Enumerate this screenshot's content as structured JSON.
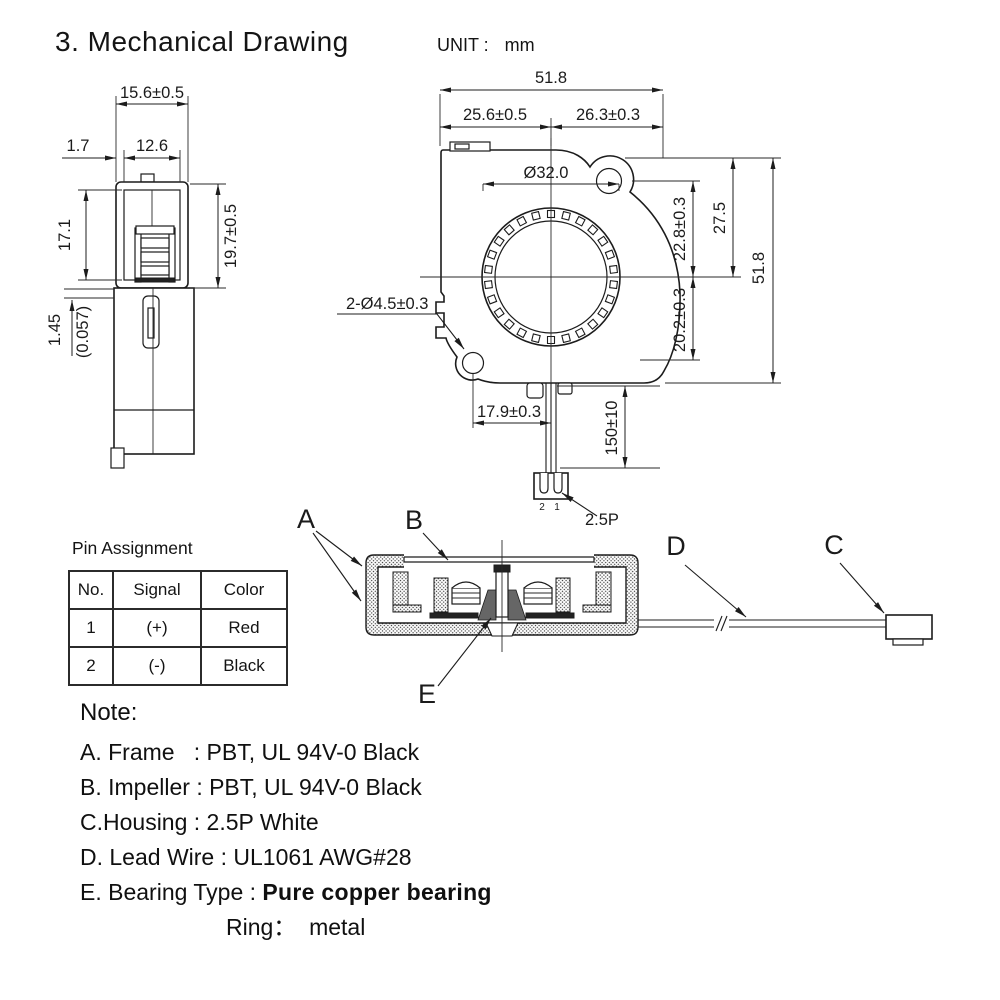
{
  "title": "3. Mechanical Drawing",
  "unit": {
    "label": "UNIT :",
    "value": "mm"
  },
  "side_view": {
    "width": "15.6±0.5",
    "offset": "1.7",
    "inner_width": "12.6",
    "motor_height": "17.1",
    "depth": "19.7±0.5",
    "step": "1.45",
    "step_inch": "(0.057)"
  },
  "front_view": {
    "total_width": "51.8",
    "left_half": "25.6±0.5",
    "right_half": "26.3±0.3",
    "inlet_dia": "Ø32.0",
    "mount_holes": "2-Ø4.5±0.3",
    "hole_to_center": "22.8±0.3",
    "top_to_center": "27.5",
    "total_height": "51.8",
    "center_to_hole": "20.2±0.3",
    "hole_to_wire": "17.9±0.3",
    "lead_length": "150±10",
    "pin_2": "2",
    "pin_1": "1",
    "connector_type": "2.5P"
  },
  "section": {
    "label_a": "A",
    "label_b": "B",
    "label_c": "C",
    "label_d": "D",
    "label_e": "E"
  },
  "pin_table": {
    "title": "Pin Assignment",
    "headers": [
      "No.",
      "Signal",
      "Color"
    ],
    "rows": [
      [
        "1",
        "(+)",
        "Red"
      ],
      [
        "2",
        "(-)",
        "Black"
      ]
    ]
  },
  "notes": {
    "heading": "Note:",
    "line_a": "A. Frame   : PBT, UL 94V-0 Black",
    "line_b": "B. Impeller : PBT, UL 94V-0 Black",
    "line_c": "C.Housing : 2.5P White",
    "line_d": "D. Lead Wire : UL1061 AWG#28",
    "line_e_label": "E. Bearing Type : ",
    "line_e_value": "Pure copper bearing",
    "line_ring": "Ring：  metal"
  },
  "colors": {
    "line": "#1c1c1c",
    "background": "#ffffff"
  }
}
